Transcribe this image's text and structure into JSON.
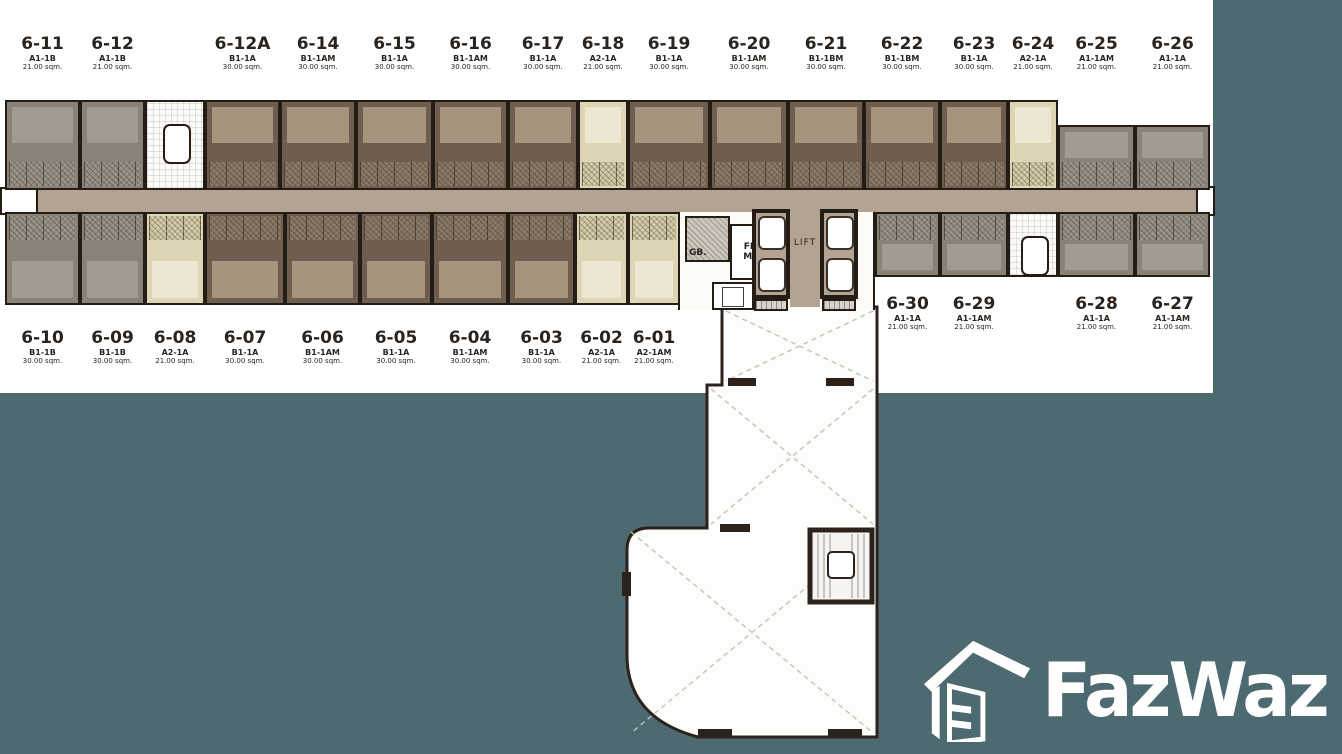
{
  "palette": {
    "teal": "#4e6a71",
    "wall": "#241d16",
    "corridor": "#b2a392",
    "unit_gray": "#8a8177",
    "unit_gray_light": "#a39b8f",
    "unit_brown": "#6f5e50",
    "unit_brown_light": "#a6947f",
    "unit_beige": "#ddd5b4",
    "unit_beige_light": "#ece6d2",
    "label_text": "#2b241e",
    "plan_background": "#ffffff"
  },
  "core": {
    "gb_label": "GB.",
    "fireman_line1": "FIRE",
    "fireman_line2": "MAN",
    "lift_label": "LIFT"
  },
  "watermark": {
    "brand": "FazWaz"
  },
  "plan": {
    "rows": {
      "top": {
        "y1": 100,
        "y2": 190,
        "label_y": 36,
        "units": [
          {
            "no": "6-11",
            "type": "A1-1B",
            "area": "21.00 sqm.",
            "x": 5,
            "w": 75,
            "c": "gray"
          },
          {
            "no": "6-12",
            "type": "A1-1B",
            "area": "21.00 sqm.",
            "x": 80,
            "w": 65,
            "c": "gray"
          },
          {
            "stair": true,
            "x": 145,
            "w": 60,
            "c": "white"
          },
          {
            "no": "6-12A",
            "type": "B1-1A",
            "area": "30.00 sqm.",
            "x": 205,
            "w": 75,
            "c": "brown"
          },
          {
            "no": "6-14",
            "type": "B1-1AM",
            "area": "30.00 sqm.",
            "x": 280,
            "w": 76,
            "c": "brown"
          },
          {
            "no": "6-15",
            "type": "B1-1A",
            "area": "30.00 sqm.",
            "x": 356,
            "w": 77,
            "c": "brown"
          },
          {
            "no": "6-16",
            "type": "B1-1AM",
            "area": "30.00 sqm.",
            "x": 433,
            "w": 75,
            "c": "brown"
          },
          {
            "no": "6-17",
            "type": "B1-1A",
            "area": "30.00 sqm.",
            "x": 508,
            "w": 70,
            "c": "brown"
          },
          {
            "no": "6-18",
            "type": "A2-1A",
            "area": "21.00 sqm.",
            "x": 578,
            "w": 50,
            "c": "beige"
          },
          {
            "no": "6-19",
            "type": "B1-1A",
            "area": "30.00 sqm.",
            "x": 628,
            "w": 82,
            "c": "brown"
          },
          {
            "no": "6-20",
            "type": "B1-1AM",
            "area": "30.00 sqm.",
            "x": 710,
            "w": 78,
            "c": "brown"
          },
          {
            "no": "6-21",
            "type": "B1-1BM",
            "area": "30.00 sqm.",
            "x": 788,
            "w": 76,
            "c": "brown"
          },
          {
            "no": "6-22",
            "type": "B1-1BM",
            "area": "30.00 sqm.",
            "x": 864,
            "w": 76,
            "c": "brown"
          },
          {
            "no": "6-23",
            "type": "B1-1A",
            "area": "30.00 sqm.",
            "x": 940,
            "w": 68,
            "c": "brown"
          },
          {
            "no": "6-24",
            "type": "A2-1A",
            "area": "21.00 sqm.",
            "x": 1008,
            "w": 50,
            "c": "beige"
          },
          {
            "no": "6-25",
            "type": "A1-1AM",
            "area": "21.00 sqm.",
            "x": 1058,
            "w": 77,
            "c": "gray",
            "y1": 125
          },
          {
            "no": "6-26",
            "type": "A1-1A",
            "area": "21.00 sqm.",
            "x": 1135,
            "w": 75,
            "c": "gray",
            "y1": 125
          }
        ]
      },
      "bottom": {
        "y1": 212,
        "y2": 305,
        "label_y": 330,
        "units": [
          {
            "no": "6-10",
            "type": "B1-1B",
            "area": "30.00 sqm.",
            "x": 5,
            "w": 75,
            "c": "gray"
          },
          {
            "no": "6-09",
            "type": "B1-1B",
            "area": "30.00 sqm.",
            "x": 80,
            "w": 65,
            "c": "gray"
          },
          {
            "no": "6-08",
            "type": "A2-1A",
            "area": "21.00 sqm.",
            "x": 145,
            "w": 60,
            "c": "beige"
          },
          {
            "no": "6-07",
            "type": "B1-1A",
            "area": "30.00 sqm.",
            "x": 205,
            "w": 80,
            "c": "brown"
          },
          {
            "no": "6-06",
            "type": "B1-1AM",
            "area": "30.00 sqm.",
            "x": 285,
            "w": 75,
            "c": "brown"
          },
          {
            "no": "6-05",
            "type": "B1-1A",
            "area": "30.00 sqm.",
            "x": 360,
            "w": 72,
            "c": "brown"
          },
          {
            "no": "6-04",
            "type": "B1-1AM",
            "area": "30.00 sqm.",
            "x": 432,
            "w": 76,
            "c": "brown"
          },
          {
            "no": "6-03",
            "type": "B1-1A",
            "area": "30.00 sqm.",
            "x": 508,
            "w": 67,
            "c": "brown"
          },
          {
            "no": "6-02",
            "type": "A2-1A",
            "area": "21.00 sqm.",
            "x": 575,
            "w": 53,
            "c": "beige"
          },
          {
            "no": "6-01",
            "type": "A2-1AM",
            "area": "21.00 sqm.",
            "x": 628,
            "w": 52,
            "c": "beige"
          },
          {
            "no": "6-30",
            "type": "A1-1A",
            "area": "21.00 sqm.",
            "x": 875,
            "w": 65,
            "c": "gray",
            "y2": 277,
            "ly": 296
          },
          {
            "no": "6-29",
            "type": "A1-1AM",
            "area": "21.00 sqm.",
            "x": 940,
            "w": 68,
            "c": "gray",
            "y2": 277,
            "ly": 296
          },
          {
            "stair": true,
            "x": 1008,
            "w": 50,
            "c": "white",
            "y2": 277
          },
          {
            "no": "6-28",
            "type": "A1-1A",
            "area": "21.00 sqm.",
            "x": 1058,
            "w": 77,
            "c": "gray",
            "y2": 277,
            "ly": 296
          },
          {
            "no": "6-27",
            "type": "A1-1AM",
            "area": "21.00 sqm.",
            "x": 1135,
            "w": 75,
            "c": "gray",
            "y2": 277,
            "ly": 296
          }
        ]
      }
    }
  }
}
